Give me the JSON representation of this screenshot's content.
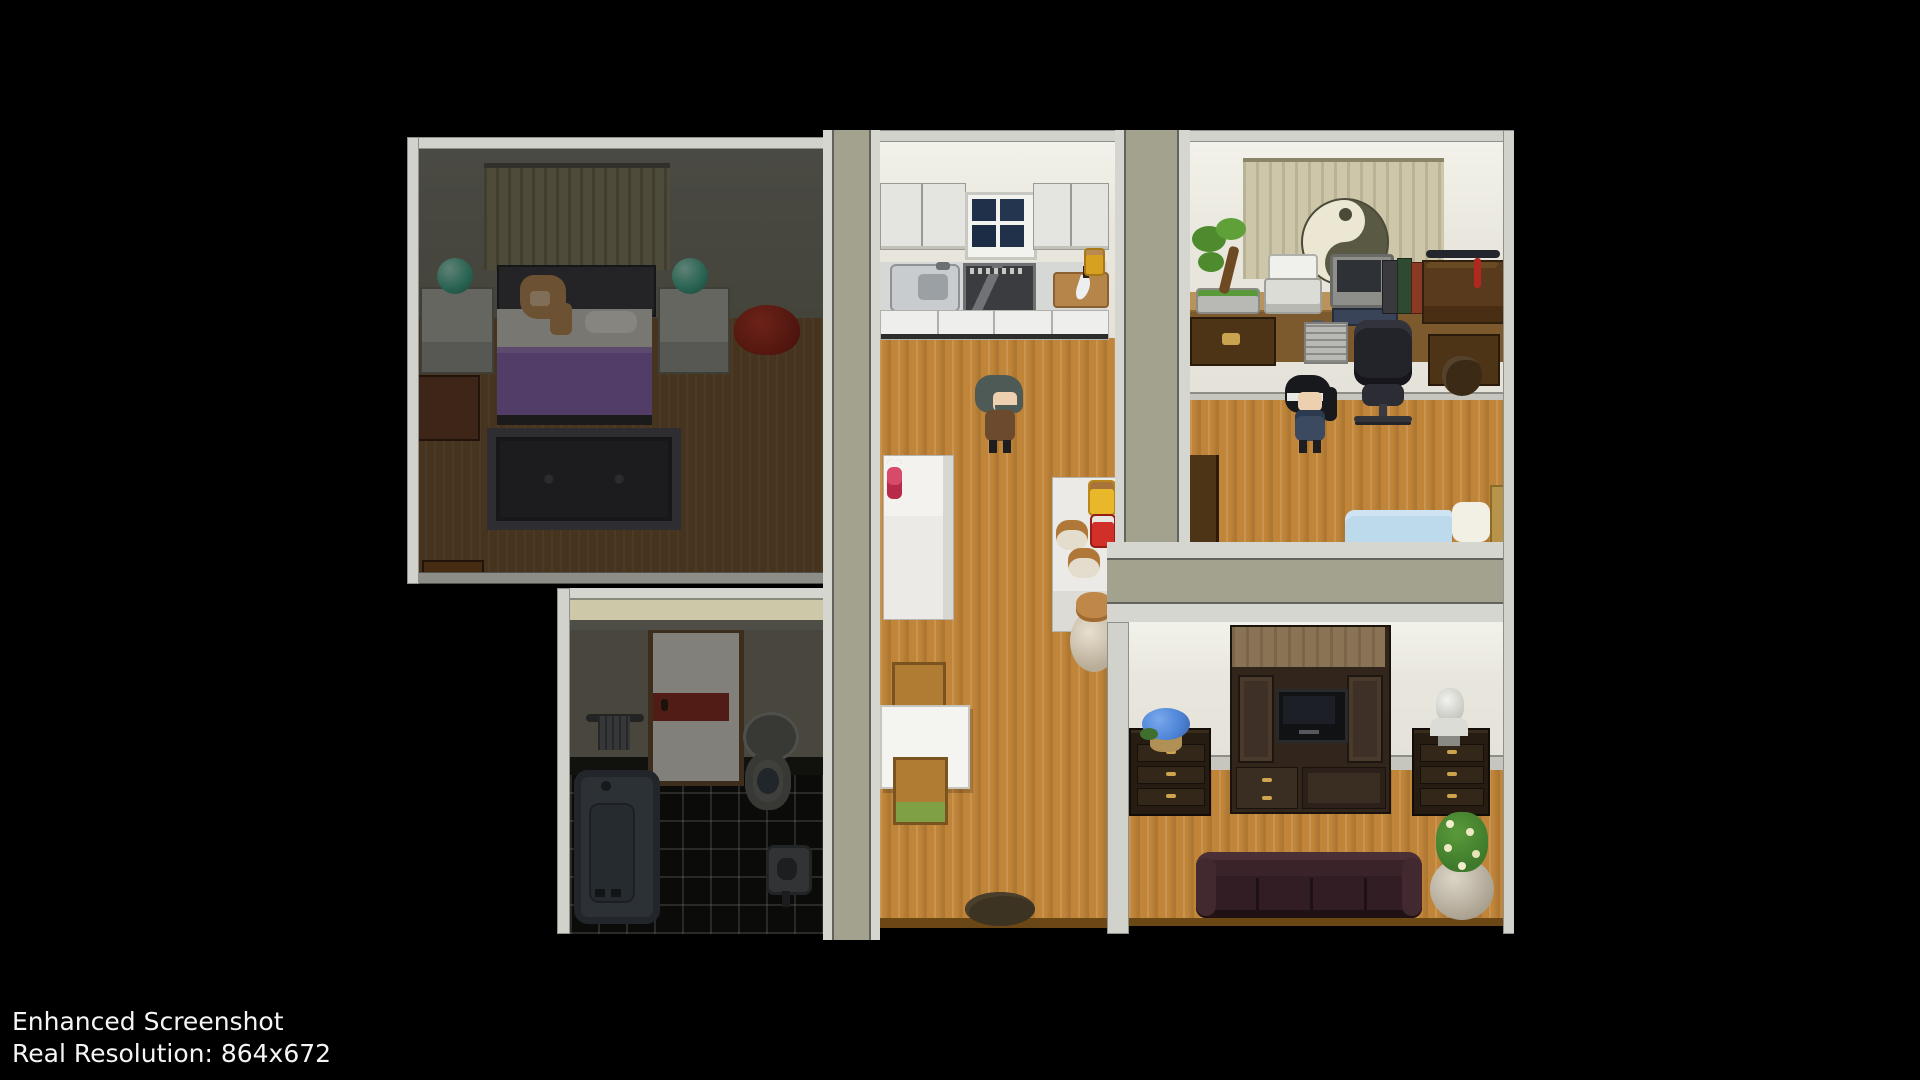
{
  "overlay": {
    "line1": "Enhanced Screenshot",
    "line2": "Real Resolution: 864x672"
  },
  "palette": {
    "trim_light": "#d2d2cc",
    "wall_olive": "#a3a28e",
    "wall_cream": "#e9e7dd",
    "floor_wood": "#c18539",
    "dim_shade": "rgba(6,6,4,0.45)",
    "bed_purple": "#8f6ab8",
    "blanket_blue": "#bdd9ec",
    "sofa_maroon": "#38232a",
    "tile_black": "#101010",
    "accent_red": "#b03028"
  },
  "scene": {
    "style": "top-down RPG interior, house with five rooms",
    "rooms": [
      {
        "id": "bedroom",
        "state": "dark",
        "objects": [
          "curtain",
          "double-bed",
          "sleeping-woman",
          "nightstand-left",
          "crystal-ball-left",
          "nightstand-right",
          "crystal-ball-right",
          "red-beanbag",
          "dresser",
          "low-cabinet",
          "ornate-rug"
        ]
      },
      {
        "id": "bathroom",
        "state": "dark",
        "objects": [
          "door-red-stripe",
          "towel-rack",
          "toilet",
          "bathtub",
          "wash-basin",
          "black-tile-floor"
        ]
      },
      {
        "id": "kitchen-dining",
        "state": "lit",
        "objects": [
          "upper-cabinet-left",
          "kitchen-window",
          "upper-cabinet-right",
          "sink-counter",
          "stove",
          "cutting-board-with-knife",
          "spice-jar",
          "refrigerator",
          "fire-extinguisher",
          "pantry-shelf",
          "honey-jar",
          "jam-jar",
          "clay-pot",
          "clay-pot",
          "storage-urn",
          "dining-table",
          "chair-north",
          "chair-south",
          "floor-mat"
        ]
      },
      {
        "id": "office",
        "state": "lit",
        "objects": [
          "yin-yang-curtain",
          "bonsai-tree",
          "printer",
          "computer-monitor",
          "keyboard",
          "mouse",
          "binder-shelf",
          "long-desk",
          "pc-tower",
          "desk-drawers",
          "sword-rack",
          "side-table",
          "satchel-drawers",
          "office-chair",
          "blue-bed"
        ]
      },
      {
        "id": "living-room",
        "state": "lit",
        "objects": [
          "entertainment-center",
          "television",
          "drawer-chest-left",
          "blue-flower-pot",
          "drawer-chest-right",
          "marble-bust",
          "leather-sofa",
          "potted-plant"
        ]
      }
    ],
    "characters": [
      {
        "id": "sleeping-woman",
        "location": "bedroom-bed",
        "appearance": "long light-brown hair, lying in bed"
      },
      {
        "id": "man-gray-beard",
        "location": "kitchen",
        "appearance": "gray hair and beard, brown coat, facing right"
      },
      {
        "id": "person-ponytail-headband",
        "location": "office",
        "appearance": "black hair, white headband, ponytail, dark blue outfit"
      }
    ]
  }
}
